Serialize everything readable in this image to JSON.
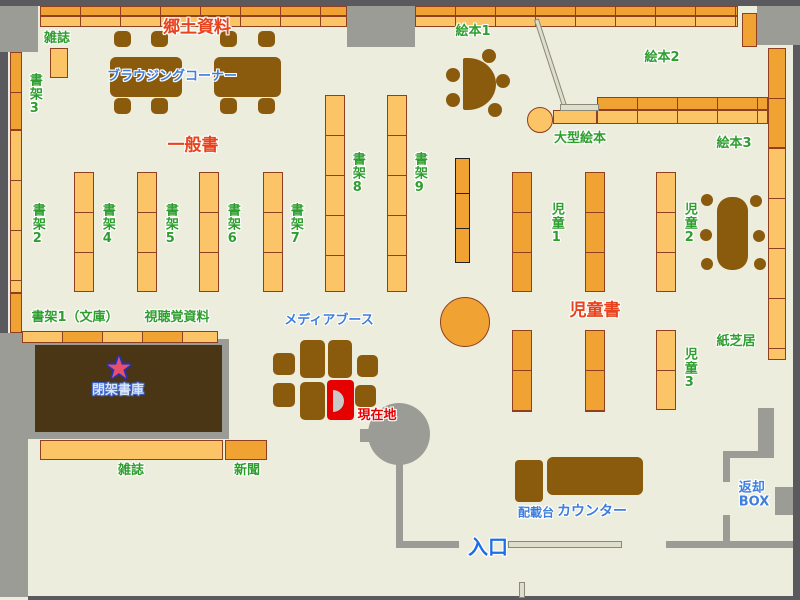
{
  "palette": {
    "floor": "#ECEDDC",
    "wall_gray": "#9C9C96",
    "wall_dark": "#5A5A5E",
    "shelf_light": "#FBC466",
    "shelf_dark": "#F0A233",
    "shelf_border": "#8E4020",
    "furniture_brown": "#8A5A0D",
    "stack_brown": "#4A3615",
    "label_green": "#2F9E2F",
    "label_red": "#E8431C",
    "label_blue": "#3D7EDE",
    "highlight_red": "#E60000",
    "partition_beige": "#DFDECB"
  },
  "icons": {
    "star": "★"
  },
  "areas": {
    "local_history": "郷土資料",
    "general_books": "一般書",
    "children_books": "児童書"
  },
  "labels": {
    "magazines_top": "雑誌",
    "browsing_corner": "ブラウジングコーナー",
    "picture_books_1": "絵本1",
    "picture_books_2": "絵本2",
    "picture_books_3": "絵本3",
    "large_picture_books": "大型絵本",
    "shelf_1_bunko": "書架1（文庫）",
    "shelf_2": "書架2",
    "shelf_3": "書架3",
    "shelf_4": "書架4",
    "shelf_5": "書架5",
    "shelf_6": "書架6",
    "shelf_7": "書架7",
    "shelf_8": "書架8",
    "shelf_9": "書架9",
    "children_1": "児童1",
    "children_2": "児童2",
    "children_3": "児童3",
    "av_materials": "視聴覚資料",
    "media_booth": "メディアブース",
    "closed_stacks": "閉架書庫",
    "current_location": "現在地",
    "kamishibai": "紙芝居",
    "magazines_bottom": "雑誌",
    "newspapers": "新聞",
    "entrance": "入口",
    "counter": "カウンター",
    "delivery_stand": "配載台",
    "return_box_line1": "返却",
    "return_box_line2": "BOX"
  }
}
